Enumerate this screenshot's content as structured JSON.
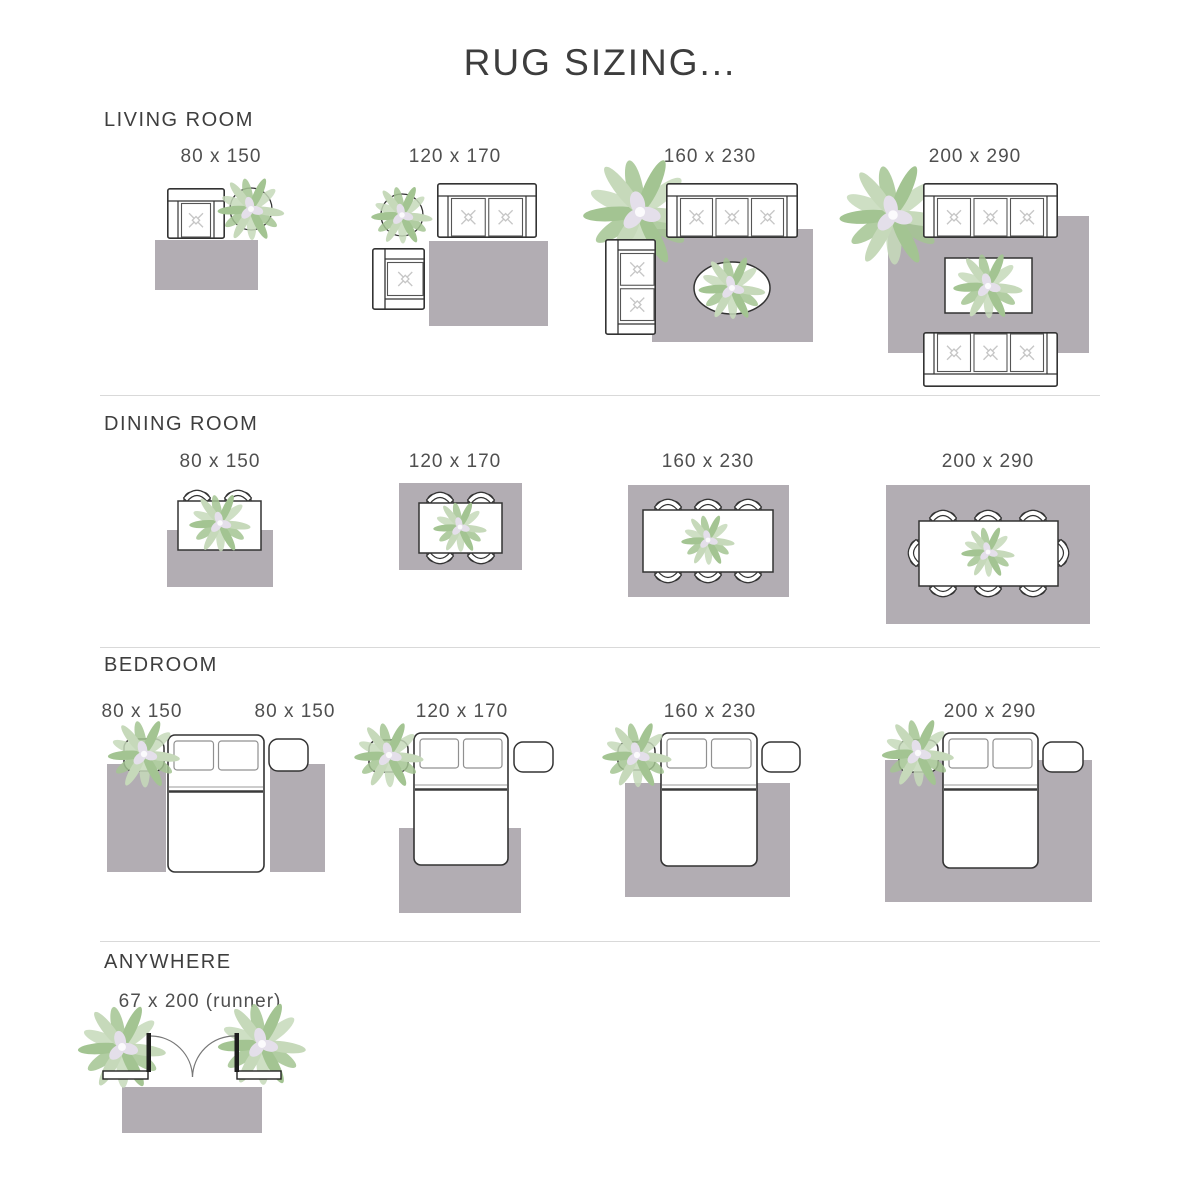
{
  "header": {
    "title": "RUG SIZING..."
  },
  "sections": [
    {
      "id": "living-room",
      "label": "LIVING ROOM",
      "sizes": [
        "80 x 150",
        "120 x 170",
        "160 x 230",
        "200 x 290"
      ]
    },
    {
      "id": "dining-room",
      "label": "DINING ROOM",
      "sizes": [
        "80 x 150",
        "120 x 170",
        "160 x 230",
        "200 x 290"
      ]
    },
    {
      "id": "bedroom",
      "label": "BEDROOM",
      "sizes": [
        "80 x 150",
        "80 x 150",
        "120 x 170",
        "160 x 230",
        "200 x 290"
      ]
    },
    {
      "id": "anywhere",
      "label": "ANYWHERE",
      "sizes": [
        "67 x 200 (runner)"
      ]
    }
  ],
  "colors": {
    "rug": "#b2adb3",
    "outline": "#333333",
    "cushion_stroke": "#555555",
    "cushion_mark": "#c6c6c6",
    "pillow_stroke": "#909090",
    "blanket_line": "#3a3a3a",
    "leaf": "#a3c492",
    "leaf_light": "#c6d9ba",
    "flower": "#e4dfea",
    "divider": "#d9d9d9",
    "text": "#3d3d3d",
    "label_text": "#4f4f4f"
  }
}
